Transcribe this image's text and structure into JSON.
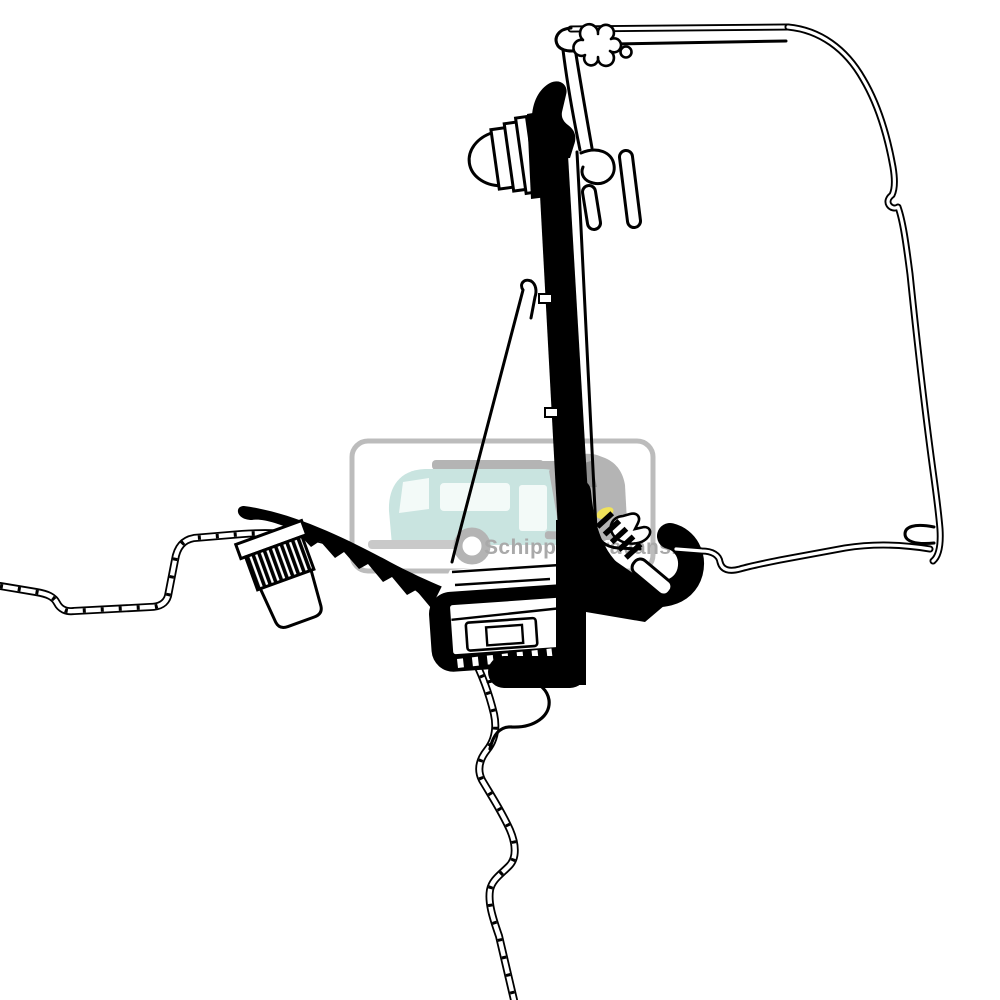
{
  "page": {
    "title": "Awning adapter bracket technical line drawing",
    "background_color": "#ffffff",
    "line_color": "#000000"
  },
  "watermark": {
    "text": "Schippercaravans.nl",
    "text_color": "#a9a9a9",
    "border_color": "#bcbcbc",
    "caravan_color": "#c9e4e0",
    "caravan_window_color": "#f3faf8",
    "roofrail_color": "#b4b4b4",
    "car_color": "#b4b4b4",
    "car_window_color": "#8f8f8f",
    "headlight_color": "#f0e25a",
    "skirt_color": "#c9c9c9",
    "wheel_color": "#b4b4b4"
  }
}
